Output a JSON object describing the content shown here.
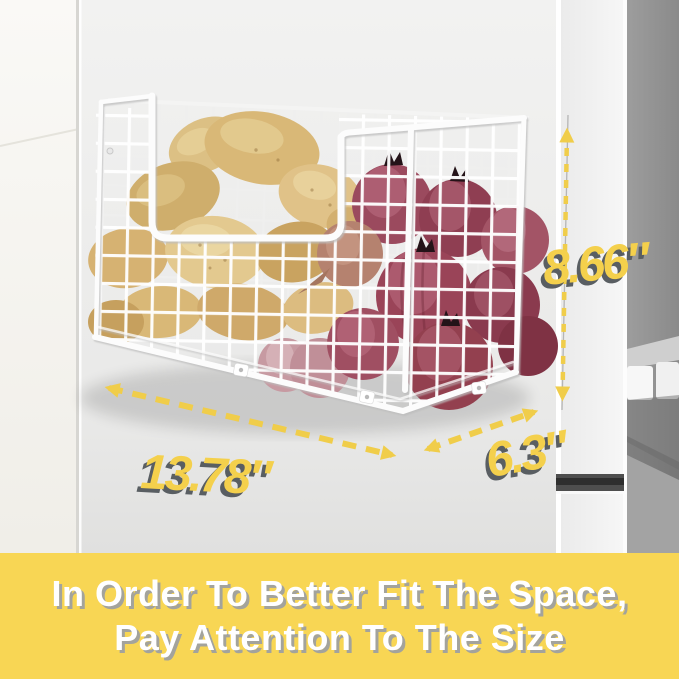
{
  "dimensions": {
    "height": {
      "value": "8.66″"
    },
    "width": {
      "value": "13.78″"
    },
    "depth": {
      "value": "6.3″"
    }
  },
  "banner": {
    "line1": "In Order To Better Fit The Space,",
    "line2": "Pay Attention To The Size"
  },
  "scene": {
    "items": [
      "wire-basket",
      "potatoes",
      "red-onions",
      "refrigerator-side",
      "refrigerator-door-handle"
    ]
  },
  "colors": {
    "arrow_yellow": "#f0cd4a",
    "label_yellow": "#f4d04c",
    "label_shadow": "#595e62",
    "banner_background": "#f8d654",
    "banner_text": "#ffffff",
    "basket_wire": "#fbfbfb",
    "potato": "#d9b877",
    "onion": "#9a4458",
    "fridge_panel": "#ececec"
  }
}
